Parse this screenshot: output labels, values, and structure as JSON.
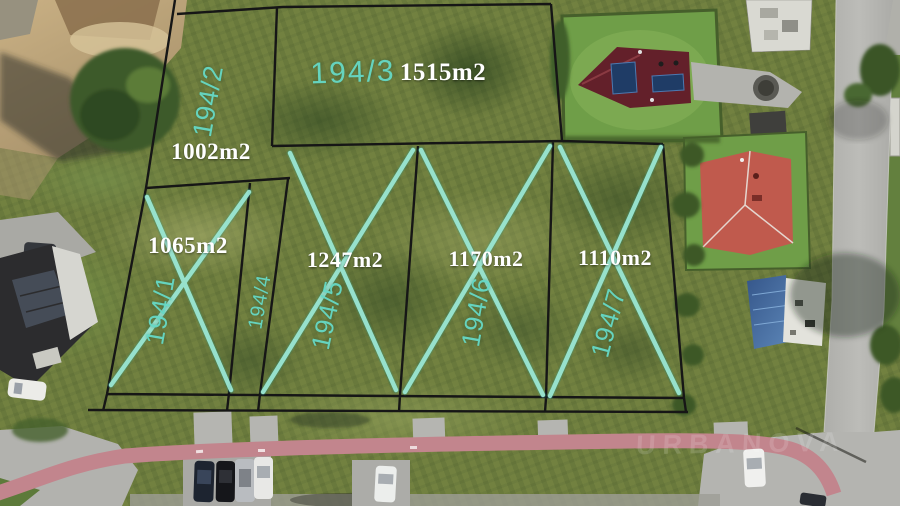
{
  "scene": {
    "description": "Aerial drone photo of surveyed land parcels for sale with plot boundary overlay",
    "watermark": "URBANOVA"
  },
  "plots": [
    {
      "id": "194/1",
      "area": "1065m2",
      "crossed_out": true
    },
    {
      "id": "194/2",
      "area": "1002m2",
      "crossed_out": false
    },
    {
      "id": "194/3",
      "area": "1515m2",
      "crossed_out": false
    },
    {
      "id": "194/4",
      "area": "",
      "crossed_out": false
    },
    {
      "id": "194/5",
      "area": "1247m2",
      "crossed_out": true
    },
    {
      "id": "194/6",
      "area": "1170m2",
      "crossed_out": true
    },
    {
      "id": "194/7",
      "area": "1110m2",
      "crossed_out": true
    }
  ],
  "colors": {
    "plot-line": "#161616",
    "cross": "#9ce8d6",
    "plot-id-text": "#66d9c6",
    "area-text": "#ffffff",
    "grass-base": "#71803f",
    "lawn": "#6f9e48",
    "dirt": "#c2a87d",
    "road": "#b5b5b1",
    "bike-path": "#c2858d",
    "roof-dark-red": "#63202a",
    "roof-salmon": "#c05a4d",
    "roof-blue": "#3f6a9c",
    "solar-panel": "#1f3c66",
    "car-white": "#eceeec",
    "car-dark": "#1d2430"
  }
}
